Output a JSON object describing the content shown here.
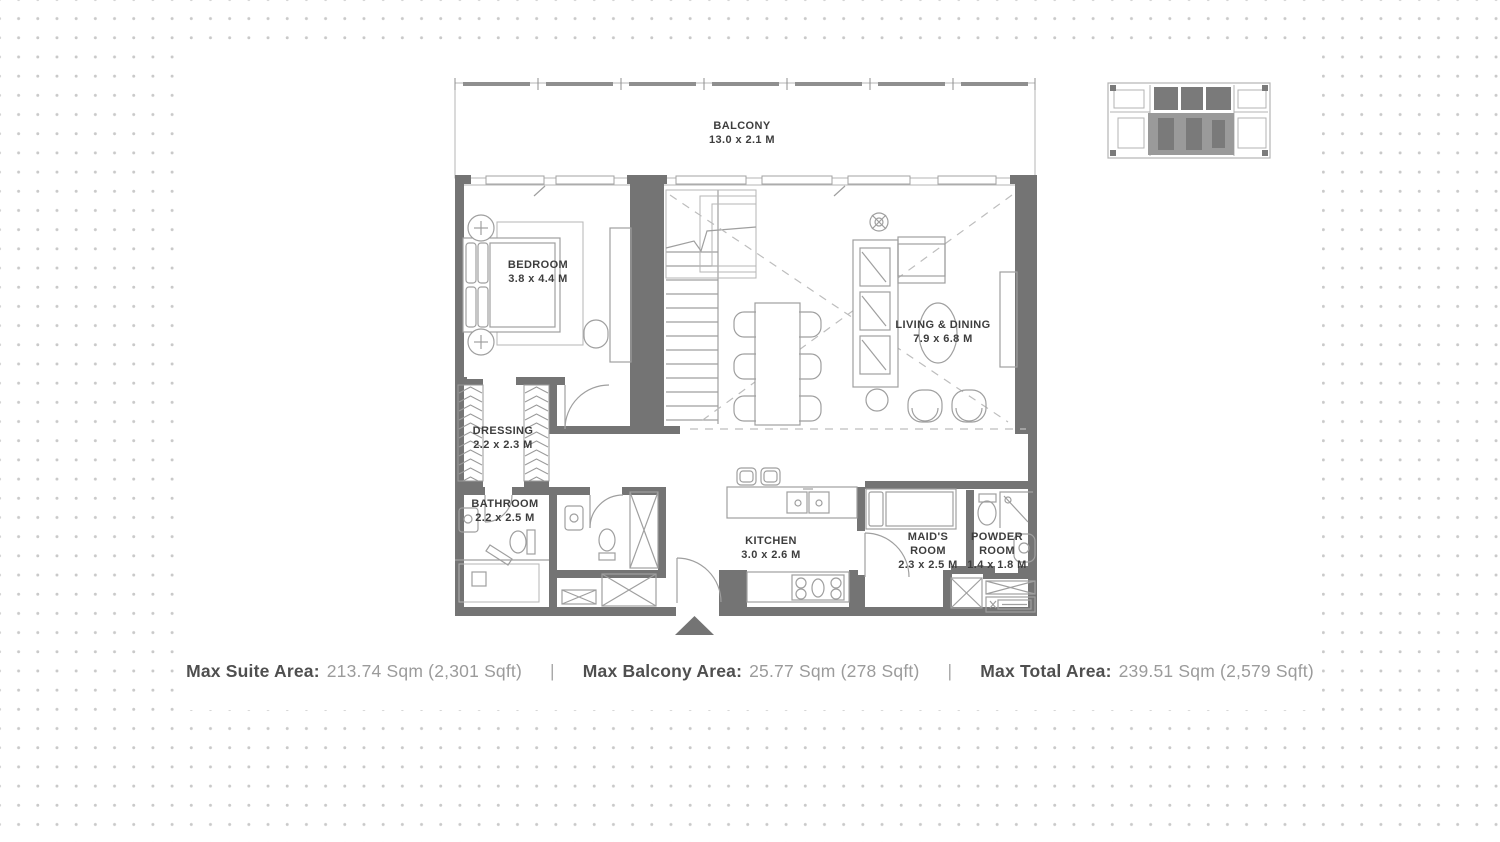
{
  "colors": {
    "wall": "#747474",
    "furniture_line": "#9f9f9f",
    "dot": "#c9c9c9",
    "label_text": "#3d3d3d",
    "footer_label": "#4f4f4f",
    "footer_value": "#9b9b9b",
    "keyplan_highlight": "#9a9a9a"
  },
  "rooms": {
    "balcony": {
      "name": "BALCONY",
      "dims": "13.0 x 2.1 M"
    },
    "bedroom": {
      "name": "BEDROOM",
      "dims": "3.8 x 4.4 M"
    },
    "living_dining": {
      "name": "LIVING & DINING",
      "dims": "7.9 x 6.8 M"
    },
    "dressing": {
      "name": "DRESSING",
      "dims": "2.2 x 2.3 M"
    },
    "bathroom": {
      "name": "BATHROOM",
      "dims": "2.2 x 2.5 M"
    },
    "kitchen": {
      "name": "KITCHEN",
      "dims": "3.0 x 2.6 M"
    },
    "maids_room": {
      "line1": "MAID'S",
      "line2": "ROOM",
      "dims": "2.3 x 2.5 M"
    },
    "powder_room": {
      "line1": "POWDER",
      "line2": "ROOM",
      "dims": "1.4 x 1.8 M"
    }
  },
  "footer": {
    "separator": "|",
    "items": [
      {
        "label": "Max Suite Area:",
        "value": "213.74 Sqm (2,301 Sqft)"
      },
      {
        "label": "Max Balcony Area:",
        "value": "25.77 Sqm (278 Sqft)"
      },
      {
        "label": "Max Total Area:",
        "value": "239.51 Sqm (2,579 Sqft)"
      }
    ]
  }
}
